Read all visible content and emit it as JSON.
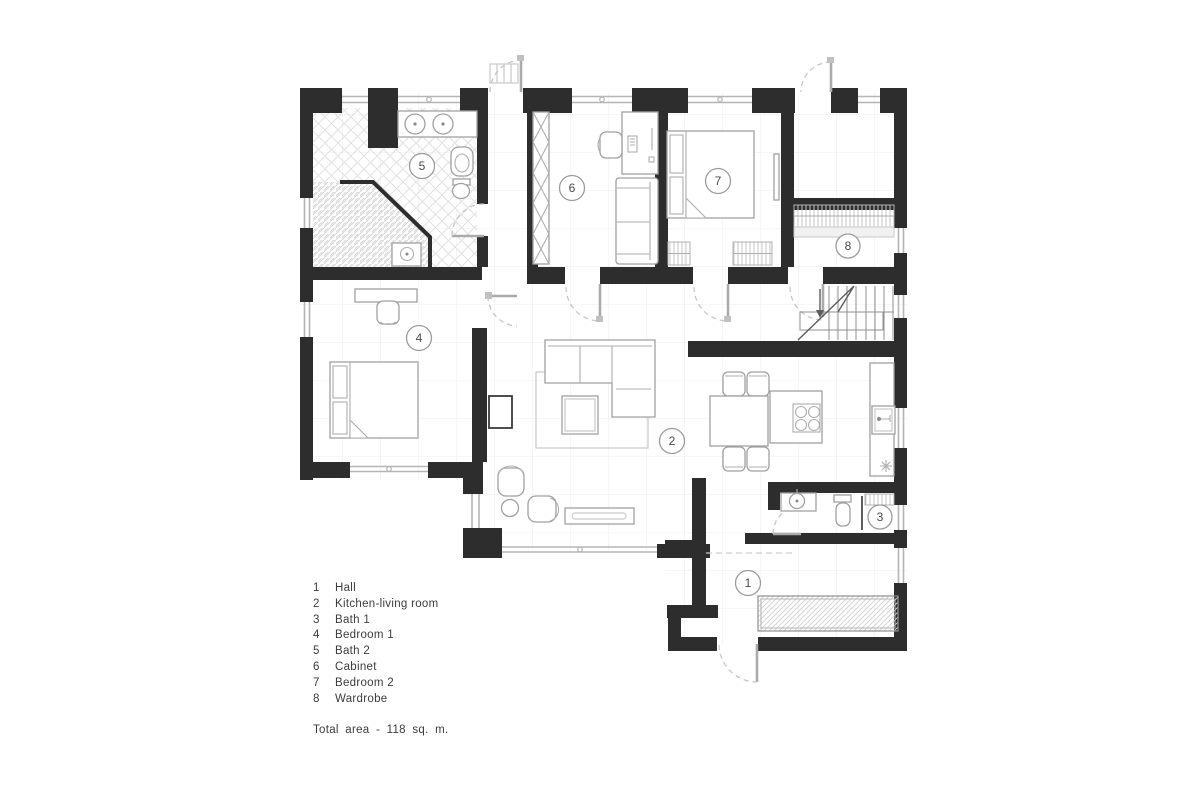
{
  "plan": {
    "rooms": [
      {
        "number": "1",
        "label": "Hall"
      },
      {
        "number": "2",
        "label": "Kitchen-living room"
      },
      {
        "number": "3",
        "label": "Bath 1"
      },
      {
        "number": "4",
        "label": "Bedroom 1"
      },
      {
        "number": "5",
        "label": "Bath 2"
      },
      {
        "number": "6",
        "label": "Cabinet"
      },
      {
        "number": "7",
        "label": "Bedroom 2"
      },
      {
        "number": "8",
        "label": "Wardrobe"
      }
    ],
    "total_area": "Total area - 118 sq. m."
  },
  "colors": {
    "wall": "#2d2d2d",
    "furniture_line": "#a0a0a0",
    "window_line": "#b5b5b5",
    "hatch": "#dadada",
    "grid": "#ededed",
    "text": "#3c3c3c",
    "background": "#ffffff"
  }
}
